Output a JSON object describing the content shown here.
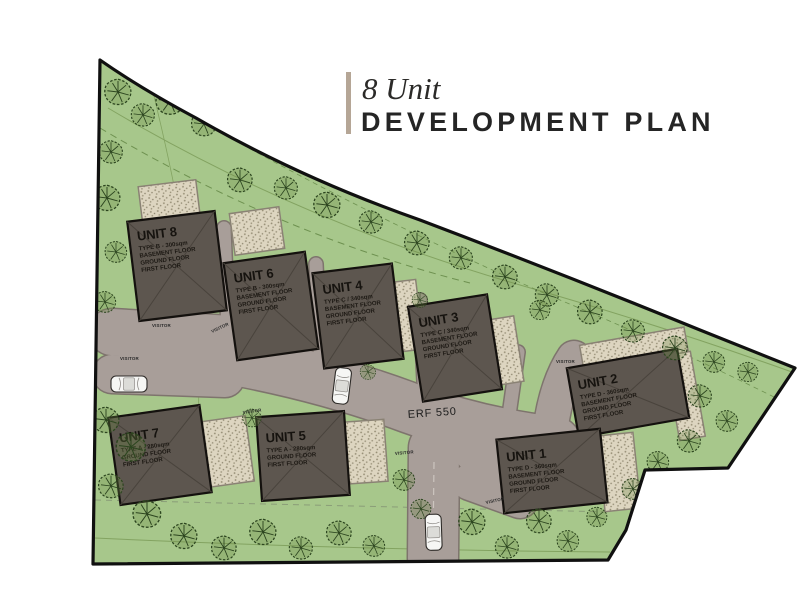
{
  "title": {
    "subtitle": "8 Unit",
    "heading": "DEVELOPMENT PLAN"
  },
  "site": {
    "erf": "ERF 550",
    "visitor": "VISITOR"
  },
  "units": [
    {
      "name": "UNIT 1",
      "type": "TYPE D - 360sqm",
      "floors": [
        "BASEMENT FLOOR",
        "GROUND FLOOR",
        "FIRST FLOOR"
      ]
    },
    {
      "name": "UNIT 2",
      "type": "TYPE D - 360sqm",
      "floors": [
        "BASEMENT FLOOR",
        "GROUND FLOOR",
        "FIRST FLOOR"
      ]
    },
    {
      "name": "UNIT 3",
      "type": "TYPE C / 340sqm",
      "floors": [
        "BASEMENT FLOOR",
        "GROUND FLOOR",
        "FIRST FLOOR"
      ]
    },
    {
      "name": "UNIT 4",
      "type": "TYPE C / 340sqm",
      "floors": [
        "BASEMENT FLOOR",
        "GROUND FLOOR",
        "FIRST FLOOR"
      ]
    },
    {
      "name": "UNIT 5",
      "type": "TYPE A - 280sqm",
      "floors": [
        "GROUND FLOOR",
        "FIRST FLOOR"
      ]
    },
    {
      "name": "UNIT 6",
      "type": "TYPE B - 300sqm",
      "floors": [
        "BASEMENT FLOOR",
        "GROUND FLOOR",
        "FIRST FLOOR"
      ]
    },
    {
      "name": "UNIT 7",
      "type": "TYPE A - 280sqm",
      "floors": [
        "GROUND FLOOR",
        "FIRST FLOOR"
      ]
    },
    {
      "name": "UNIT 8",
      "type": "TYPE B - 300sqm",
      "floors": [
        "BASEMENT FLOOR",
        "GROUND FLOOR",
        "FIRST FLOOR"
      ]
    }
  ],
  "colors": {
    "grass": "#a7c78b",
    "road": "#a89e99",
    "road_edge": "#7e746d",
    "driveway": "#ddd5c0",
    "roof": "#5d564f",
    "boundary": "#101010",
    "accent_bar": "#b5a696",
    "title_text": "#252525"
  }
}
